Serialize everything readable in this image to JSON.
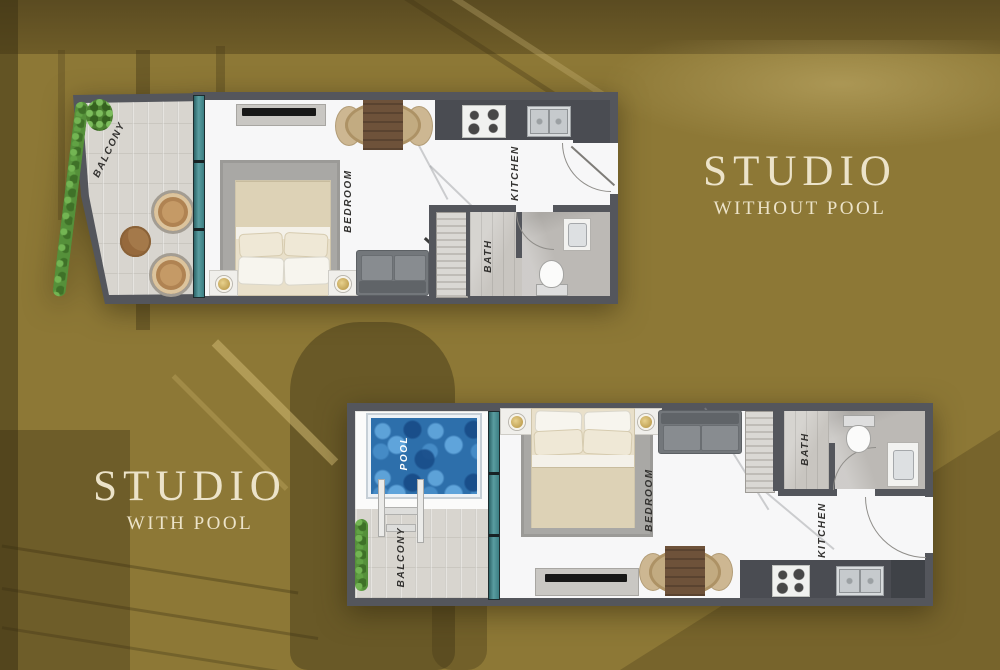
{
  "poster": {
    "background_color": "#8d7836",
    "title_color": "#ece3c9",
    "wall_color": "#54565c",
    "pool_color": "#2d6fab",
    "glass_door_color": "#3c7f83"
  },
  "plans": [
    {
      "name": "studio-without-pool",
      "title_line1": "STUDIO",
      "title_line2": "WITHOUT POOL",
      "labels": {
        "balcony": "BALCONY",
        "bedroom": "BEDROOM",
        "kitchen": "KITCHEN",
        "bath": "BATH"
      }
    },
    {
      "name": "studio-with-pool",
      "title_line1": "STUDIO",
      "title_line2": "WITH POOL",
      "labels": {
        "pool": "POOL",
        "balcony": "BALCONY",
        "bedroom": "BEDROOM",
        "kitchen": "KITCHEN",
        "bath": "BATH"
      }
    }
  ]
}
